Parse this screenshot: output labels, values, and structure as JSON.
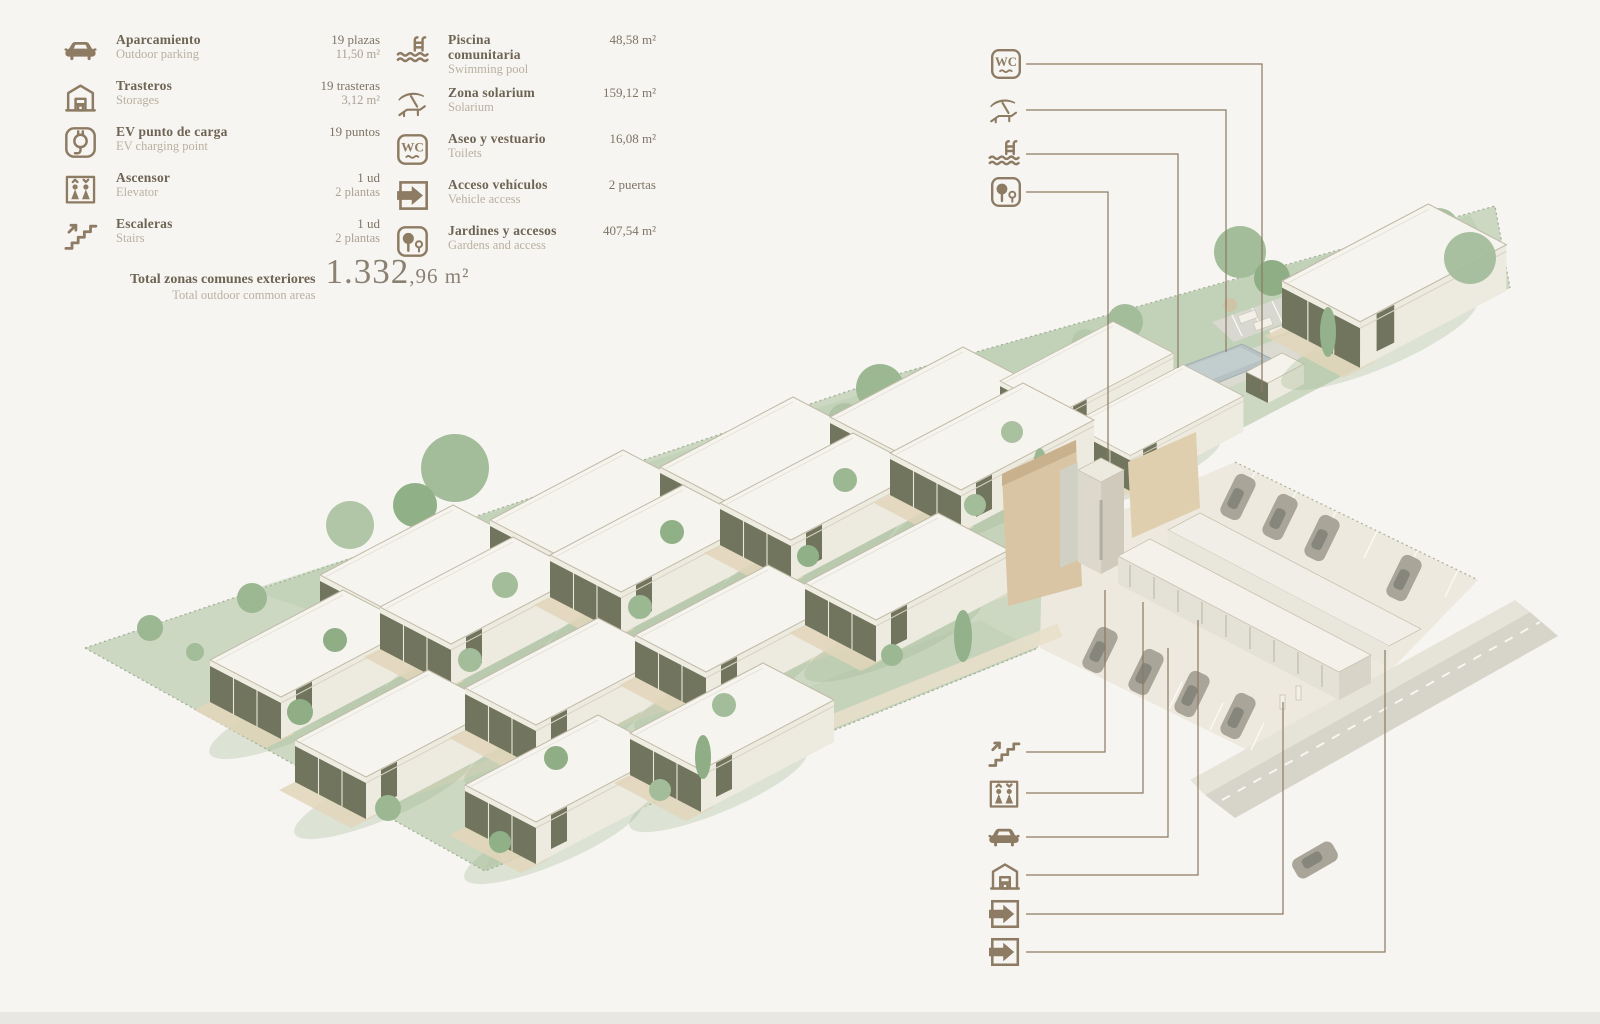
{
  "legend": {
    "items_col1": [
      {
        "icon": "car",
        "name_es": "Aparcamiento",
        "name_en": "Outdoor parking",
        "value_line1": "19 plazas",
        "value_line2": "11,50 m²"
      },
      {
        "icon": "storage",
        "name_es": "Trasteros",
        "name_en": "Storages",
        "value_line1": "19 trasteras",
        "value_line2": "3,12 m²"
      },
      {
        "icon": "ev",
        "name_es": "EV punto de carga",
        "name_en": "EV charging point",
        "value_line1": "19 puntos",
        "value_line2": ""
      },
      {
        "icon": "elevator",
        "name_es": "Ascensor",
        "name_en": "Elevator",
        "value_line1": "1 ud",
        "value_line2": "2 plantas"
      },
      {
        "icon": "stairs",
        "name_es": "Escaleras",
        "name_en": "Stairs",
        "value_line1": "1 ud",
        "value_line2": "2 plantas"
      }
    ],
    "items_col2": [
      {
        "icon": "pool",
        "name_es": "Piscina comunitaria",
        "name_en": "Swimming pool",
        "value_line1": "48,58 m²",
        "value_line2": ""
      },
      {
        "icon": "solarium",
        "name_es": "Zona solarium",
        "name_en": "Solarium",
        "value_line1": "159,12 m²",
        "value_line2": ""
      },
      {
        "icon": "wc",
        "name_es": "Aseo y vestuario",
        "name_en": "Toilets",
        "value_line1": "16,08 m²",
        "value_line2": ""
      },
      {
        "icon": "access",
        "name_es": "Acceso vehículos",
        "name_en": "Vehicle access",
        "value_line1": "2 puertas",
        "value_line2": ""
      },
      {
        "icon": "gardens",
        "name_es": "Jardines y accesos",
        "name_en": "Gardens and access",
        "value_line1": "407,54 m²",
        "value_line2": ""
      }
    ],
    "total": {
      "label_es": "Total zonas comunes exteriores",
      "label_en": "Total outdoor common areas",
      "value_big": "1.332",
      "value_small": ",96 m²"
    }
  },
  "callouts": {
    "top": [
      "wc",
      "solarium",
      "pool",
      "gardens"
    ],
    "bottom": [
      "stairs",
      "elevator",
      "car",
      "storage",
      "access",
      "access"
    ]
  },
  "icons": {
    "wc_label": "WC"
  },
  "colors": {
    "background": "#f7f5f1",
    "icon_brown": "#8d7b63",
    "text_dark": "#6e6454",
    "text_light": "#b9b0a1",
    "terrain_green": "#ccd8c2",
    "tree_green": "#9fb796",
    "house_white": "#f6f4ee",
    "glazing_olive": "#72755e",
    "wall_tan": "#d9c5a4",
    "pool_blue": "#b6c1c3",
    "parking_beige": "#eee9de",
    "road_gray": "#d7d4c9"
  }
}
